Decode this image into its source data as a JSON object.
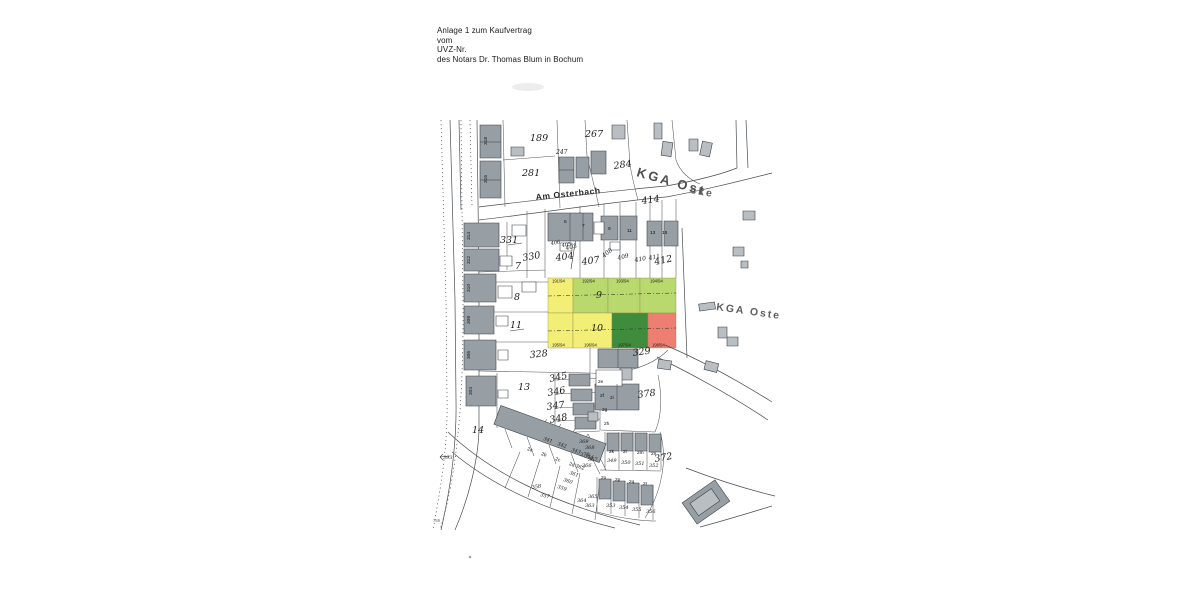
{
  "header": {
    "lines": [
      "Anlage 1 zum Kaufvertrag",
      "vom",
      "UVZ-Nr.",
      "des Notars Dr. Thomas Blum in Bochum"
    ]
  },
  "map": {
    "streets": {
      "am_osterbach": "Am Osterbach",
      "kga_main": "KGA Ost",
      "kga_main_tail": "cke",
      "kga_right": "KGA Oste"
    },
    "colors": {
      "yellow": "#f3ef76",
      "light_green": "#b9d86e",
      "dark_green": "#3e8c3c",
      "red": "#ee7e72",
      "building": "#979ea4",
      "building_light": "#b9bec2",
      "annex": "#ffffff",
      "line": "#4a4e52"
    },
    "parcels": {
      "p189": "189",
      "p267": "267",
      "p247": "247",
      "p281": "281",
      "p284": "284",
      "p414": "414",
      "p331": "331",
      "p330": "330",
      "p404": "404",
      "p403": "403",
      "p405": "405",
      "p406": "406",
      "p407": "407",
      "p408": "408",
      "p409": "409",
      "p410": "410",
      "p411": "411",
      "p412": "412",
      "p7": "7",
      "p8": "8",
      "p9": "9",
      "p10": "10",
      "p11": "11",
      "p13": "13",
      "p14": "14",
      "p328": "328",
      "p329": "329",
      "p345": "345",
      "p346": "346",
      "p347": "347",
      "p348": "348",
      "p378": "378",
      "p372": "372",
      "p341": "341",
      "p342": "342",
      "p343": "343",
      "p344": "344",
      "p349": "349",
      "p350": "350",
      "p351": "351",
      "p352": "352",
      "p353": "353",
      "p354": "354",
      "p355": "355",
      "p356": "356",
      "p357": "357",
      "p358": "358",
      "p359": "359",
      "p360": "360",
      "p361": "361",
      "p362": "362",
      "p363": "363",
      "p364": "364",
      "p365": "365",
      "p366": "366",
      "p367": "367",
      "p368": "368",
      "p369": "369",
      "p370": "370",
      "p393": "393",
      "p759": "759"
    },
    "fractions": {
      "f1": "191/94",
      "f2": "192/94",
      "f3": "193/94",
      "f4": "194/94",
      "f5": "195/94",
      "f6": "196/94",
      "f7": "197/94",
      "f8": "198/94"
    },
    "house_numbers": {
      "h5": "5",
      "h7": "7",
      "h9": "9",
      "h11": "11",
      "h13": "13",
      "h15": "15",
      "h2a": "2a",
      "h2b": "2b",
      "h2c": "2c",
      "h2d": "2d",
      "h2e": "2e",
      "h2f": "2f",
      "h2g": "2g",
      "h2h": "2h",
      "h2i": "2i",
      "h2k": "2k",
      "h2l": "2l",
      "h2m": "2m",
      "h2n": "2n",
      "h2o": "2o",
      "h2p": "2p",
      "h2q": "2q",
      "h2r": "2r"
    },
    "road_parcels_vertical": {
      "v318": "318",
      "v316": "316",
      "v314": "314",
      "v312": "312",
      "v310": "310",
      "v308": "308",
      "v306": "306",
      "v304": "304"
    }
  }
}
